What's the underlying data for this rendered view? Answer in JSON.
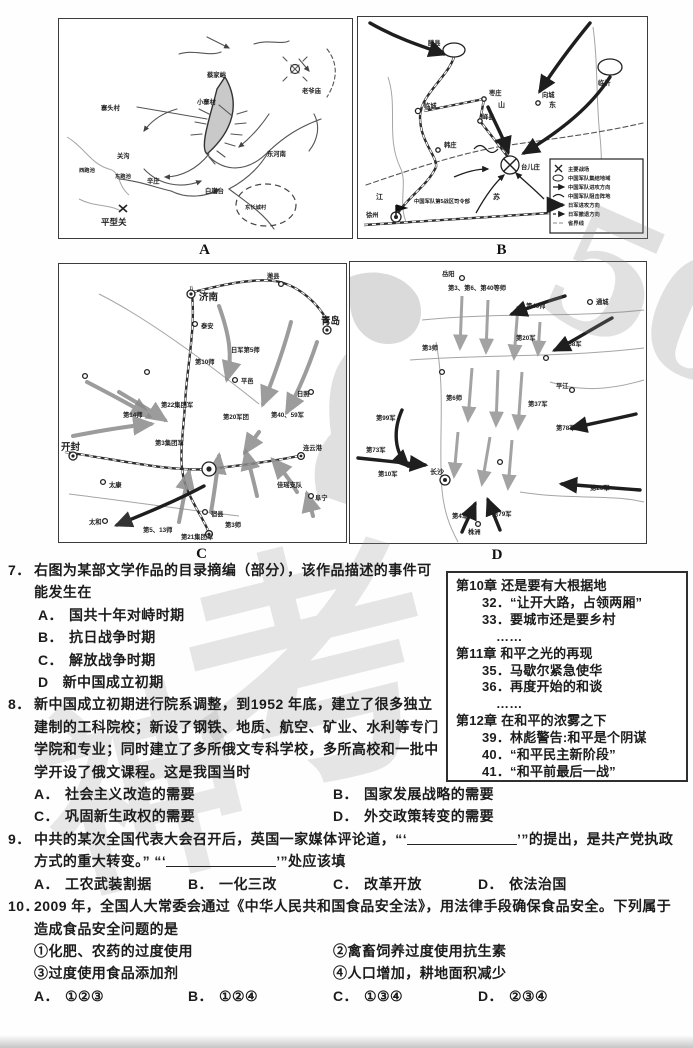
{
  "watermark": {
    "char1": "神",
    "char2": "考",
    "num": "50"
  },
  "maps": {
    "a": {
      "figure_label": "A",
      "labels": [
        "蔡家峪",
        "老爷庙",
        "寨头村",
        "小寨村",
        "关沟",
        "辛庄",
        "白崖台",
        "东河南",
        "西跑池",
        "东跑池",
        "平型关",
        "东长城村"
      ]
    },
    "b": {
      "figure_label": "B",
      "labels": [
        "滕县",
        "临城",
        "枣庄",
        "峄县",
        "韩庄",
        "台儿庄",
        "向城",
        "临沂",
        "山东",
        "江苏",
        "徐州",
        "中国军队第5战区司令部"
      ],
      "legend": [
        "主要战场",
        "中国军队集结地域",
        "中国军队进攻方向",
        "中国军队阻击阵地",
        "日军进攻方向",
        "日军撤退方向",
        "省界线"
      ]
    },
    "c": {
      "figure_label": "C",
      "labels": [
        "济南",
        "泰安",
        "潍县",
        "青岛",
        "日军第5师",
        "第10师",
        "平邑",
        "日照",
        "第22集团军",
        "第20军团",
        "第40、59军",
        "开封",
        "太康",
        "第14师",
        "第3集团军",
        "宿县",
        "第3师",
        "第5、13师",
        "第21集团军",
        "太和",
        "阜宁",
        "连云港",
        "佳瑶支队"
      ]
    },
    "d": {
      "figure_label": "D",
      "labels": [
        "岳阳",
        "通城",
        "第3、第6、第40等师",
        "第40师",
        "第20军",
        "第58军",
        "第3师",
        "第6师",
        "第37军",
        "平江",
        "第99军",
        "第78军",
        "第73军",
        "第10军",
        "长沙",
        "第26军",
        "第4军",
        "第79军",
        "株洲"
      ]
    }
  },
  "toc": {
    "lines": [
      "第10章 还是要有大根据地",
      "32．“让开大路，占领两厢”",
      "33．要城市还是要乡村",
      "……",
      "第11章 和平之光的再现",
      "35．马歇尔紧急使华",
      "36．再度开始的和谈",
      "……",
      "第12章 在和平的浓雾之下",
      "39．林彪警告:和平是个阴谋",
      "40．“和平民主新阶段”",
      "41．“和平前最后一战”"
    ]
  },
  "questions": {
    "q7": {
      "num": "7．",
      "stem": "右图为某部文学作品的目录摘编（部分），该作品描述的事件可能发生在",
      "options": [
        {
          "label": "A．",
          "text": "国共十年对峙时期"
        },
        {
          "label": "B．",
          "text": "抗日战争时期"
        },
        {
          "label": "C．",
          "text": "解放战争时期"
        },
        {
          "label": "D",
          "text": "新中国成立初期"
        }
      ]
    },
    "q8": {
      "num": "8．",
      "stem": "新中国成立初期进行院系调整，到1952 年底，建立了很多独立建制的工科院校；新设了钢铁、地质、航空、矿业、水利等专门学院和专业；同时建立了多所俄文专科学校，多所高校和一批中学开设了俄文课程。这是我国当时",
      "options": [
        {
          "label": "A．",
          "text": "社会主义改造的需要"
        },
        {
          "label": "B．",
          "text": "国家发展战略的需要"
        },
        {
          "label": "C．",
          "text": "巩固新生政权的需要"
        },
        {
          "label": "D．",
          "text": "外交政策转变的需要"
        }
      ]
    },
    "q9": {
      "num": "9．",
      "stem_parts": [
        "中共的某次全国代表大会召开后，英国一家媒体评论道，“‘",
        "’”的提出，是共产党执政方式的重大转变。”  “‘",
        "’”处应该填"
      ],
      "options": [
        {
          "label": "A．",
          "text": "工农武装割据"
        },
        {
          "label": "B．",
          "text": "一化三改"
        },
        {
          "label": "C．",
          "text": "改革开放"
        },
        {
          "label": "D．",
          "text": "依法治国"
        }
      ]
    },
    "q10": {
      "num": "10．",
      "stem": "2009 年，全国人大常委会通过《中华人民共和国食品安全法》，用法律手段确保食品安全。下列属于造成食品安全问题的是",
      "items": [
        "①化肥、农药的过度使用",
        "②禽畜饲养过度使用抗生素",
        "③过度使用食品添加剂",
        "④人口增加，耕地面积减少"
      ],
      "options": [
        {
          "label": "A．",
          "text": "①②③"
        },
        {
          "label": "B．",
          "text": "①②④"
        },
        {
          "label": "C．",
          "text": "①③④"
        },
        {
          "label": "D．",
          "text": "②③④"
        }
      ]
    }
  }
}
